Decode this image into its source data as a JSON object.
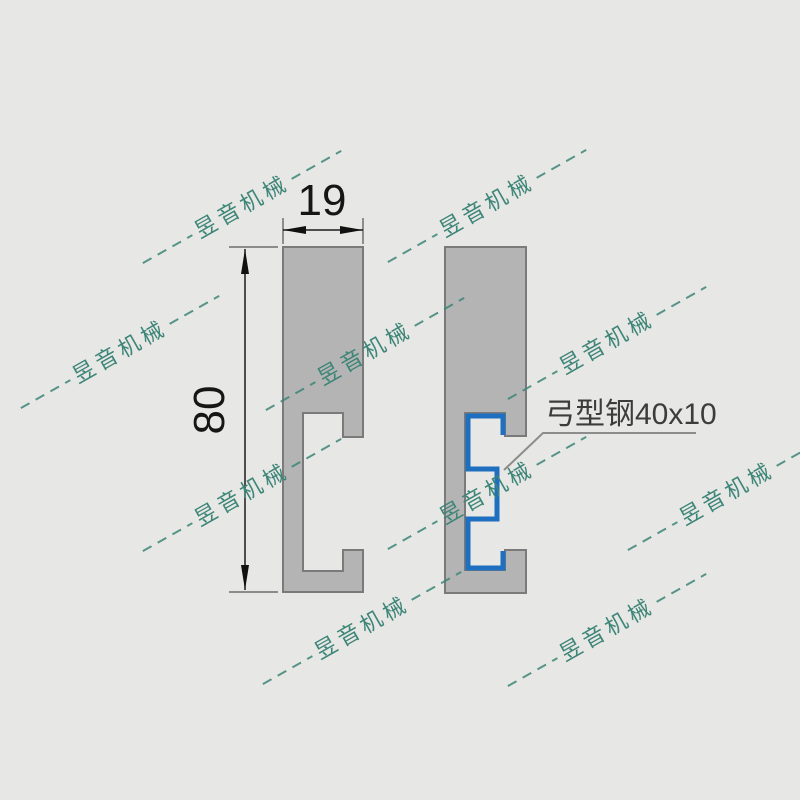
{
  "drawing": {
    "width_dim": "19",
    "height_dim": "80",
    "callout": "弓型钢40x10"
  },
  "watermark": {
    "text": "昱音机械"
  },
  "colors": {
    "background": "#e7e7e5",
    "profile_fill": "#b4b4b4",
    "profile_stroke": "#7a7a7a",
    "bow_steel_blue": "#1f6fc0",
    "watermark_teal": "#3d8577",
    "dimension_ink": "#161616",
    "leader_gray": "#8c8c8c"
  }
}
